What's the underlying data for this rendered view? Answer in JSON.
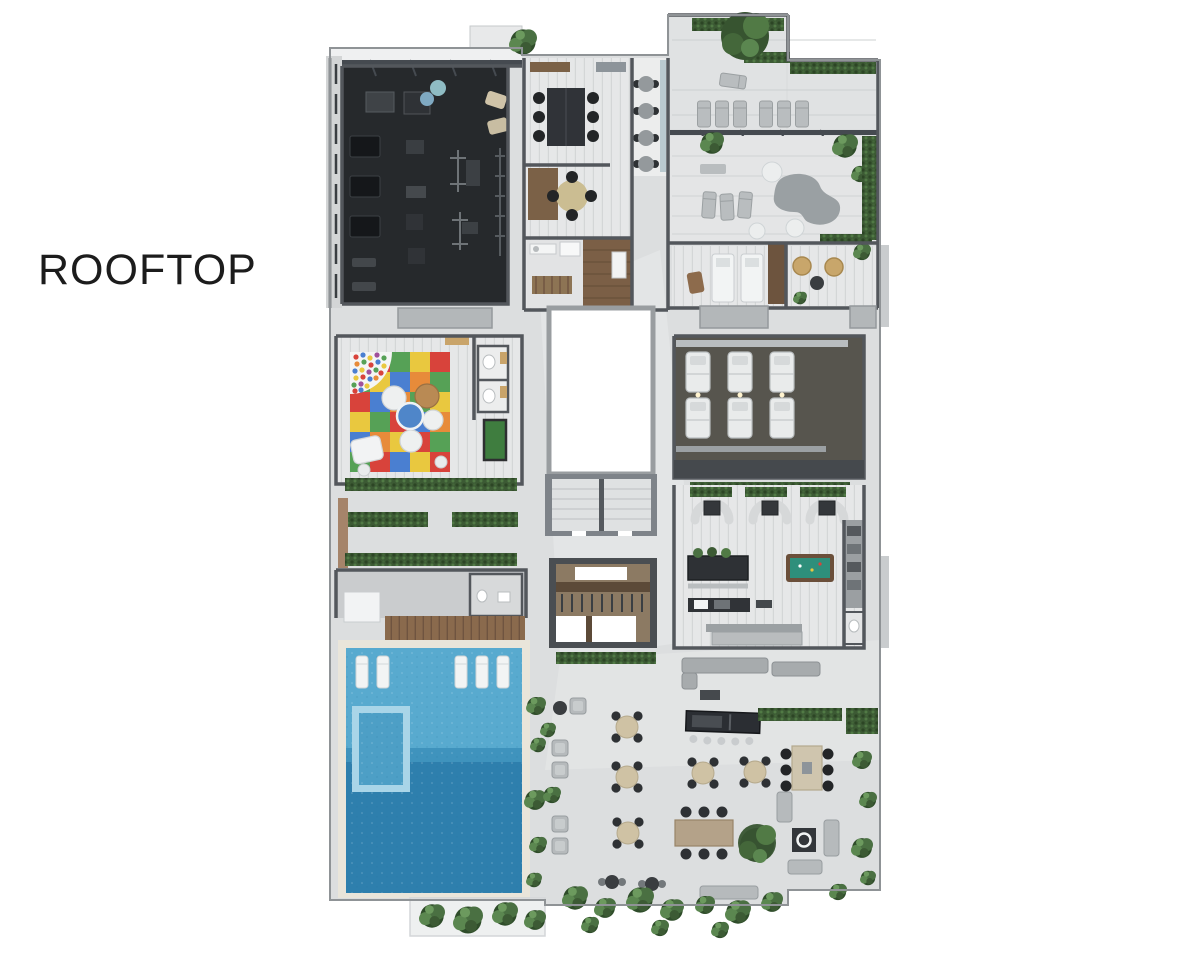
{
  "title": "ROOFTOP",
  "colors": {
    "background": "#ffffff",
    "title_text": "#1c1c1c",
    "wall": "#53575c",
    "base_floor": "#dcdedf",
    "concrete": "#e3e4e5",
    "gym_floor": "#26292c",
    "pool_shallow": "#58aacf",
    "pool_deep": "#2e7fad",
    "jacuzzi_border": "#a9d5e8",
    "jacuzzi_water": "#4d9fc6",
    "pool_edge": "#e9e5da",
    "deck_wood": "#8a6a4d",
    "pantry_wood": "#7b5f46",
    "hedge_green": "#3c5a34",
    "foliage_green": "#4a7042",
    "mat_red": "#d8433b",
    "mat_green": "#56a156",
    "mat_yellow": "#e9c83f",
    "mat_blue": "#4a7fd1",
    "mat_orange": "#e78b3a",
    "billiard_felt": "#2e8f7b",
    "billiard_frame": "#6b4f3a",
    "table_beige": "#cfc2a4",
    "sofa_gray": "#b6babc",
    "furniture_dark": "#303338",
    "white_fixture": "#f2f4f4",
    "suite_floor": "#57554e",
    "atrium_white": "#ffffff"
  }
}
